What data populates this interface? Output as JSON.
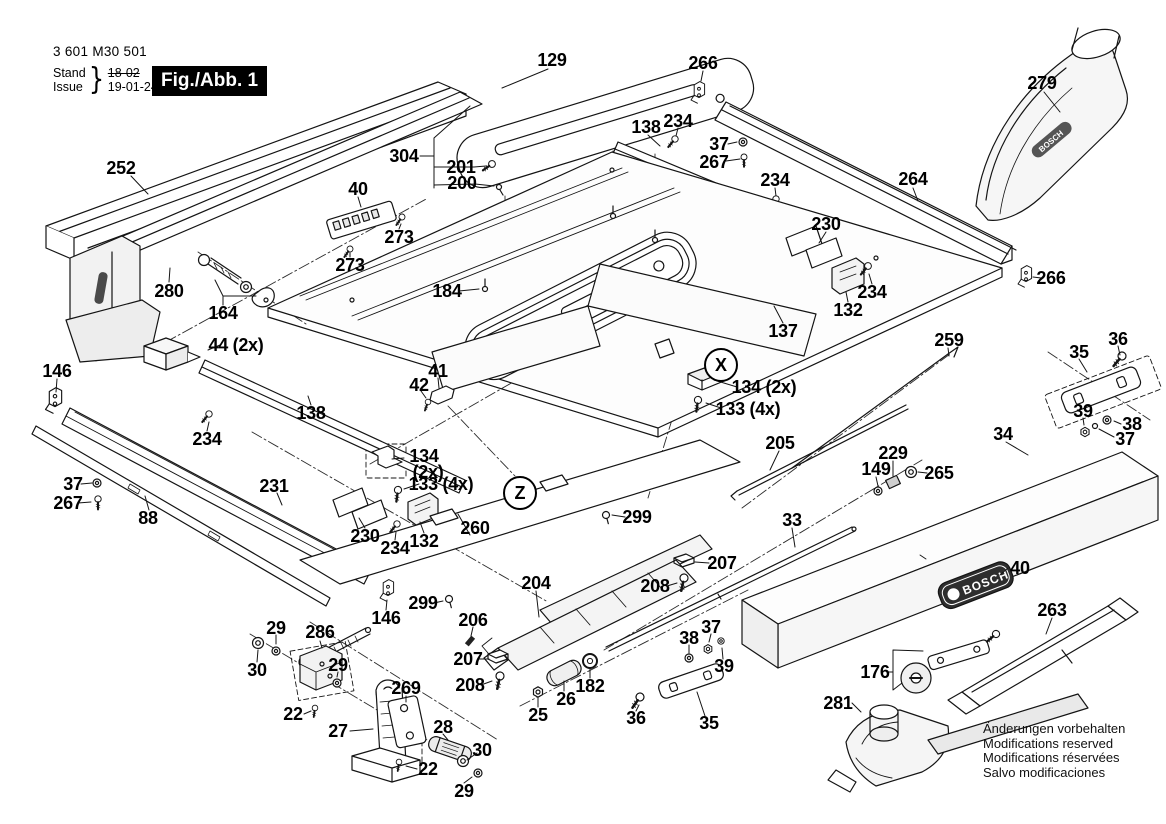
{
  "meta": {
    "width": 1166,
    "height": 824,
    "background": "#ffffff",
    "ink": "#141414"
  },
  "title_block": {
    "part_number": "3 601 M30 501",
    "stand_label": "Stand",
    "issue_label": "Issue",
    "stand_value": "18-02",
    "issue_value": "19-01-24",
    "figure_label": "Fig./Abb. 1"
  },
  "brand": {
    "badge_text": "BOSCH"
  },
  "footer": {
    "lines": [
      "Änderungen vorbehalten",
      "Modifications reserved",
      "Modifications réservées",
      "Salvo modificaciones"
    ]
  },
  "diagram": {
    "detail_markers": [
      {
        "letter": "X",
        "x": 721,
        "y": 365
      },
      {
        "letter": "Z",
        "x": 520,
        "y": 493
      }
    ],
    "labels": [
      {
        "text": "129",
        "x": 552,
        "y": 60
      },
      {
        "text": "266",
        "x": 703,
        "y": 63
      },
      {
        "text": "279",
        "x": 1042,
        "y": 83
      },
      {
        "text": "252",
        "x": 121,
        "y": 168
      },
      {
        "text": "304",
        "x": 404,
        "y": 156
      },
      {
        "text": "201",
        "x": 461,
        "y": 167
      },
      {
        "text": "200",
        "x": 462,
        "y": 183
      },
      {
        "text": "40",
        "x": 358,
        "y": 189
      },
      {
        "text": "138",
        "x": 646,
        "y": 127
      },
      {
        "text": "234",
        "x": 678,
        "y": 121
      },
      {
        "text": "37",
        "x": 719,
        "y": 144
      },
      {
        "text": "267",
        "x": 714,
        "y": 162
      },
      {
        "text": "234",
        "x": 775,
        "y": 180
      },
      {
        "text": "264",
        "x": 913,
        "y": 179
      },
      {
        "text": "230",
        "x": 826,
        "y": 224
      },
      {
        "text": "273",
        "x": 399,
        "y": 237
      },
      {
        "text": "273",
        "x": 350,
        "y": 265
      },
      {
        "text": "280",
        "x": 169,
        "y": 291
      },
      {
        "text": "164",
        "x": 223,
        "y": 313
      },
      {
        "text": "44 (2x)",
        "x": 236,
        "y": 345
      },
      {
        "text": "184",
        "x": 447,
        "y": 291
      },
      {
        "text": "234",
        "x": 872,
        "y": 292
      },
      {
        "text": "132",
        "x": 848,
        "y": 310
      },
      {
        "text": "137",
        "x": 783,
        "y": 331
      },
      {
        "text": "266",
        "x": 1051,
        "y": 278
      },
      {
        "text": "146",
        "x": 57,
        "y": 371
      },
      {
        "text": "41",
        "x": 438,
        "y": 371
      },
      {
        "text": "42",
        "x": 419,
        "y": 385
      },
      {
        "text": "134 (2x)",
        "x": 764,
        "y": 387
      },
      {
        "text": "133 (4x)",
        "x": 748,
        "y": 409
      },
      {
        "text": "259",
        "x": 949,
        "y": 340
      },
      {
        "text": "36",
        "x": 1118,
        "y": 339
      },
      {
        "text": "35",
        "x": 1079,
        "y": 352
      },
      {
        "text": "39",
        "x": 1083,
        "y": 411
      },
      {
        "text": "38",
        "x": 1132,
        "y": 424
      },
      {
        "text": "37",
        "x": 1125,
        "y": 439
      },
      {
        "text": "34",
        "x": 1003,
        "y": 434
      },
      {
        "text": "138",
        "x": 311,
        "y": 413
      },
      {
        "text": "234",
        "x": 207,
        "y": 439
      },
      {
        "text": "231",
        "x": 274,
        "y": 486
      },
      {
        "text": "37",
        "x": 73,
        "y": 484
      },
      {
        "text": "267",
        "x": 68,
        "y": 503
      },
      {
        "text": "88",
        "x": 148,
        "y": 518
      },
      {
        "text": "134",
        "x": 424,
        "y": 456
      },
      {
        "text": "(2x)",
        "x": 428,
        "y": 472
      },
      {
        "text": "133 (4x)",
        "x": 441,
        "y": 484
      },
      {
        "text": "230",
        "x": 365,
        "y": 536
      },
      {
        "text": "234",
        "x": 395,
        "y": 548
      },
      {
        "text": "132",
        "x": 424,
        "y": 541
      },
      {
        "text": "260",
        "x": 475,
        "y": 528
      },
      {
        "text": "299",
        "x": 637,
        "y": 517
      },
      {
        "text": "205",
        "x": 780,
        "y": 443
      },
      {
        "text": "229",
        "x": 893,
        "y": 453
      },
      {
        "text": "149",
        "x": 876,
        "y": 469
      },
      {
        "text": "265",
        "x": 939,
        "y": 473
      },
      {
        "text": "33",
        "x": 792,
        "y": 520
      },
      {
        "text": "204",
        "x": 536,
        "y": 583
      },
      {
        "text": "208",
        "x": 655,
        "y": 586
      },
      {
        "text": "207",
        "x": 722,
        "y": 563
      },
      {
        "text": "206",
        "x": 473,
        "y": 620
      },
      {
        "text": "207",
        "x": 468,
        "y": 659
      },
      {
        "text": "208",
        "x": 470,
        "y": 685
      },
      {
        "text": "299",
        "x": 423,
        "y": 603
      },
      {
        "text": "146",
        "x": 386,
        "y": 618
      },
      {
        "text": "29",
        "x": 276,
        "y": 628
      },
      {
        "text": "286",
        "x": 320,
        "y": 632
      },
      {
        "text": "30",
        "x": 257,
        "y": 670
      },
      {
        "text": "29",
        "x": 338,
        "y": 665
      },
      {
        "text": "22",
        "x": 293,
        "y": 714
      },
      {
        "text": "27",
        "x": 338,
        "y": 731
      },
      {
        "text": "269",
        "x": 406,
        "y": 688
      },
      {
        "text": "28",
        "x": 443,
        "y": 727
      },
      {
        "text": "22",
        "x": 428,
        "y": 769
      },
      {
        "text": "30",
        "x": 482,
        "y": 750
      },
      {
        "text": "29",
        "x": 464,
        "y": 791
      },
      {
        "text": "25",
        "x": 538,
        "y": 715
      },
      {
        "text": "26",
        "x": 566,
        "y": 699
      },
      {
        "text": "182",
        "x": 590,
        "y": 686
      },
      {
        "text": "36",
        "x": 636,
        "y": 718
      },
      {
        "text": "35",
        "x": 709,
        "y": 723
      },
      {
        "text": "38",
        "x": 689,
        "y": 638
      },
      {
        "text": "37",
        "x": 711,
        "y": 627
      },
      {
        "text": "39",
        "x": 724,
        "y": 666
      },
      {
        "text": "176",
        "x": 875,
        "y": 672
      },
      {
        "text": "281",
        "x": 838,
        "y": 703
      },
      {
        "text": "40",
        "x": 1020,
        "y": 568
      },
      {
        "text": "263",
        "x": 1052,
        "y": 610
      }
    ]
  }
}
